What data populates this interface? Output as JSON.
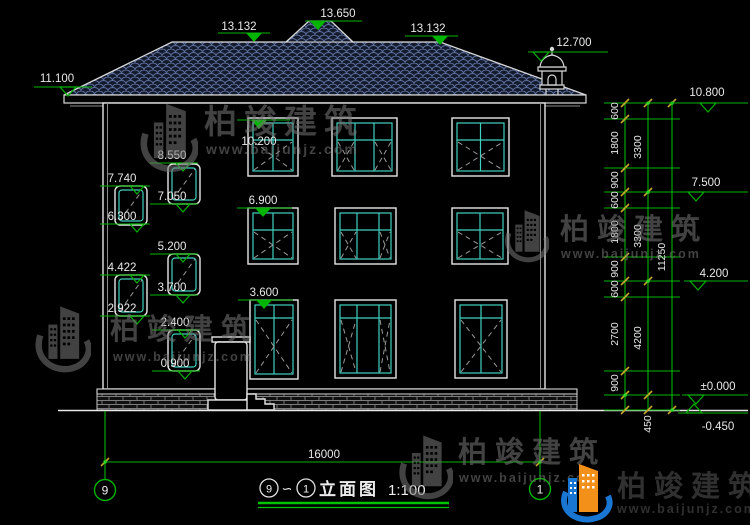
{
  "title": {
    "axis_from": "9",
    "tilde": "∽",
    "axis_to": "1",
    "name": "立面图",
    "scale": "1:100"
  },
  "axis_bubbles": {
    "left": "9",
    "right": "1"
  },
  "watermark": {
    "brand": "柏竣建筑",
    "url": "www.baijunjz.com"
  },
  "roof_marks": {
    "left_eave": "11.100",
    "ridge_left": "13.132",
    "peak": "13.650",
    "ridge_right": "13.132",
    "cupola": "12.700"
  },
  "right_marks": {
    "eave": "10.800",
    "floor3": "7.500",
    "floor2": "4.200",
    "zero": "±0.000",
    "ground": "-0.450"
  },
  "facade_marks": {
    "win3_top": "10.200",
    "win2_top": "6.900",
    "win1_top": "3.600"
  },
  "stair_marks": [
    "8.550",
    "7.740",
    "7.050",
    "6.300",
    "5.200",
    "4.422",
    "3.700",
    "2.922",
    "2.400",
    "0.900"
  ],
  "dims": {
    "chain1": [
      "600",
      "1800",
      "900",
      "600",
      "1800",
      "900",
      "600",
      "2700",
      "900",
      "450"
    ],
    "chain2": [
      "3300",
      "3300",
      "4200"
    ],
    "total_height": "11250",
    "total_width": "16000"
  },
  "colors": {
    "marker_green": "#00b400",
    "dim_tick_yellow": "#c7a52e",
    "cad_white": "#e9e9e9",
    "frame_cyan": "#3fd0c0",
    "roof_tile": "#5d6f9e",
    "brand_blue": "#1976d2",
    "brand_orange": "#f39019"
  }
}
